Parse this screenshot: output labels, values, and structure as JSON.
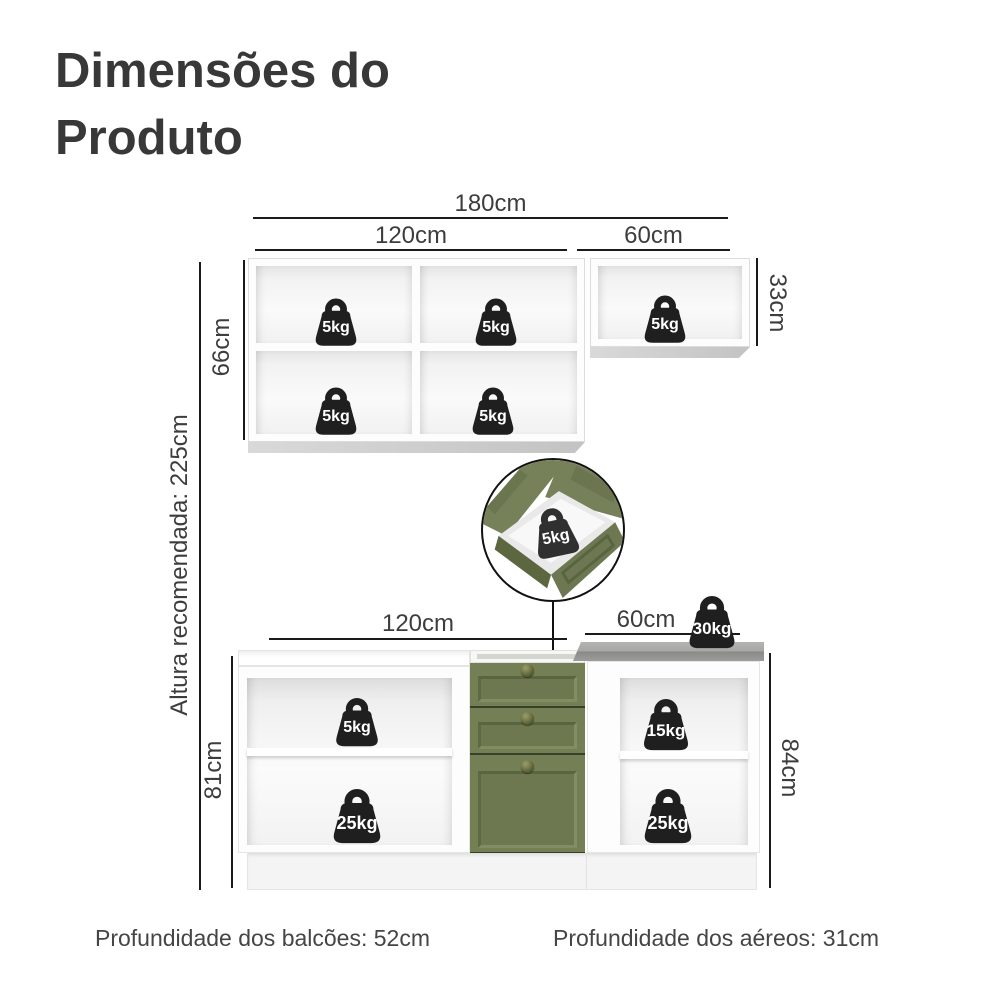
{
  "title": {
    "line1": "Dimensões do",
    "line2": "Produto"
  },
  "upper_section": {
    "total_width": "180cm",
    "left_width": "120cm",
    "right_width": "60cm",
    "left_height": "66cm",
    "right_height": "33cm",
    "weights": [
      "5kg",
      "5kg",
      "5kg",
      "5kg",
      "5kg"
    ]
  },
  "drawer_detail": {
    "weight": "5kg"
  },
  "lower_section": {
    "left_width": "120cm",
    "right_width": "60cm",
    "left_height": "81cm",
    "right_height": "84cm",
    "countertop_weight": "30kg",
    "left_weights": [
      "5kg",
      "25kg"
    ],
    "right_weights": [
      "15kg",
      "25kg"
    ]
  },
  "side_note": {
    "recommended_height": "Altura recomendada: 225cm"
  },
  "footer": {
    "counters_depth": "Profundidade dos balcões: 52cm",
    "wall_units_depth": "Profundidade dos aéreos: 31cm"
  },
  "colors": {
    "cabinet_green": "#747f56",
    "cabinet_green_dark": "#596540",
    "countertop_gray": "#9c9c9a",
    "weight_black": "#1f1f1f",
    "dimension_line": "#1a1a1a",
    "text": "#3d3d3d"
  }
}
